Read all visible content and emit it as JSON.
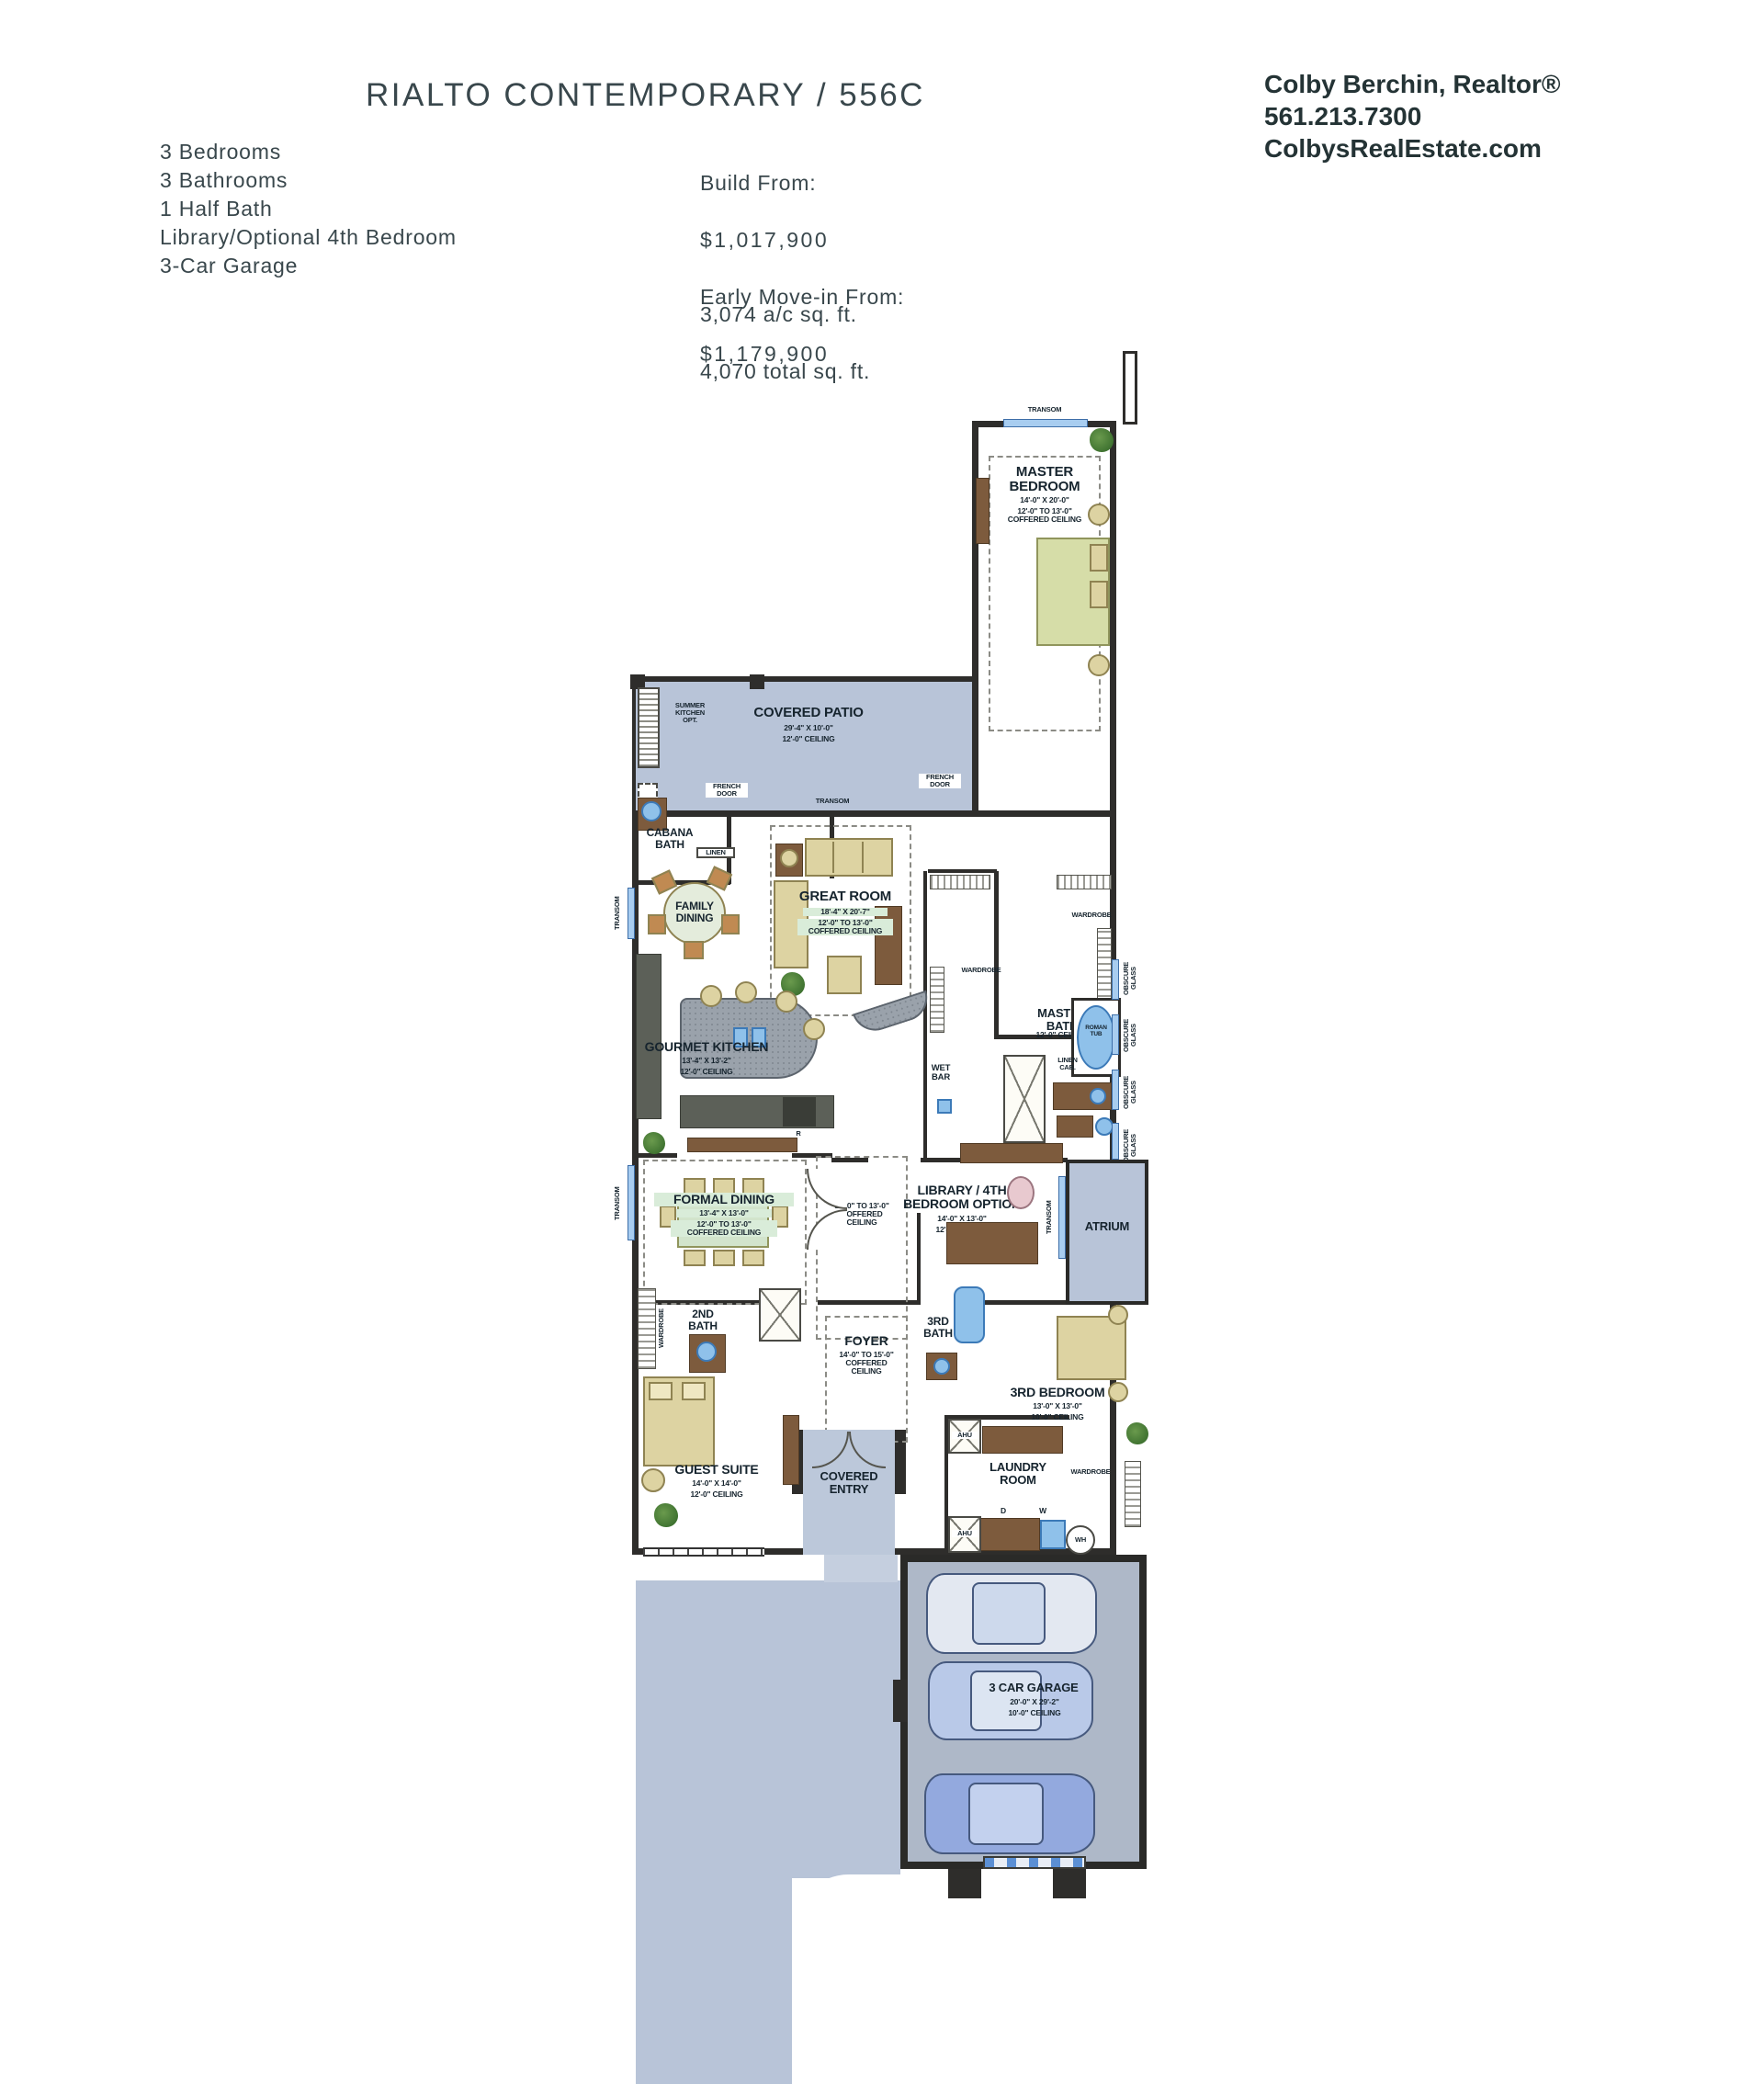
{
  "header": {
    "title": "RIALTO CONTEMPORARY / 556C",
    "realtor": {
      "name": "Colby Berchin, Realtor®",
      "phone": "561.213.7300",
      "website": "ColbysRealEstate.com"
    },
    "specs": "3 Bedrooms\n3 Bathrooms\n1 Half Bath\nLibrary/Optional 4th Bedroom\n3-Car Garage",
    "pricing": {
      "build_label": "Build From:",
      "build_price": "$1,017,900",
      "movein_label": "Early Move-in From:",
      "movein_price": "$1,179,900"
    },
    "area": {
      "ac": "3,074 a/c sq. ft.",
      "total": "4,070 total sq. ft."
    }
  },
  "floorplan": {
    "rooms": {
      "covered_patio": {
        "name": "COVERED PATIO",
        "dims": "29'-4\" X 10'-0\"",
        "ceiling": "12'-0\" CEILING"
      },
      "summer_kitchen": {
        "name": "SUMMER\nKITCHEN\nOPT."
      },
      "master_bedroom": {
        "name": "MASTER\nBEDROOM",
        "dims": "14'-0\" X 20'-0\"",
        "ceiling": "12'-0\" TO 13'-0\"\nCOFFERED CEILING"
      },
      "cabana_bath": {
        "name": "CABANA\nBATH"
      },
      "family_dining": {
        "name": "FAMILY\nDINING"
      },
      "great_room": {
        "name": "GREAT ROOM",
        "dims": "18'-4\" X 20'-7\"",
        "ceiling": "12'-0\" TO 13'-0\"\nCOFFERED CEILING"
      },
      "gourmet_kitchen": {
        "name": "GOURMET KITCHEN",
        "dims": "13'-4\" X 13'-2\"",
        "ceiling": "12'-0\" CEILING"
      },
      "master_bath": {
        "name": "MASTER\nBATH",
        "ceiling": "12'-0\" CEILING"
      },
      "formal_dining": {
        "name": "FORMAL DINING",
        "dims": "13'-4\" X 13'-0\"",
        "ceiling": "12'-0\" TO 13'-0\"\nCOFFERED CEILING"
      },
      "gallery": {
        "ceiling": "12'-0\" TO 13'-0\"\nCOFFERED\nCEILING"
      },
      "library": {
        "name": "LIBRARY / 4TH\nBEDROOM OPTION",
        "dims": "14'-0\" X 13'-0\"",
        "ceiling": "12'-0\" CEILING"
      },
      "atrium": {
        "name": "ATRIUM"
      },
      "second_bath": {
        "name": "2ND\nBATH"
      },
      "foyer": {
        "name": "FOYER",
        "ceiling": "14'-0\" TO 15'-0\"\nCOFFERED\nCEILING"
      },
      "third_bath": {
        "name": "3RD\nBATH"
      },
      "third_bedroom": {
        "name": "3RD BEDROOM",
        "dims": "13'-0\" X 13'-0\"",
        "ceiling": "10'-0\" CEILING"
      },
      "guest_suite": {
        "name": "GUEST SUITE",
        "dims": "14'-0\" X 14'-0\"",
        "ceiling": "12'-0\" CEILING"
      },
      "covered_entry": {
        "name": "COVERED\nENTRY"
      },
      "laundry": {
        "name": "LAUNDRY\nROOM",
        "dryer": "D",
        "washer": "W"
      },
      "garage": {
        "name": "3 CAR GARAGE",
        "dims": "20'-0\" X 29'-2\"",
        "ceiling": "10'-0\" CEILING"
      }
    },
    "labels": {
      "transom": "TRANSOM",
      "french_door": "FRENCH\nDOOR",
      "obscure_glass": "OBSCURE\nGLASS",
      "wardrobe": "WARDROBE",
      "linen": "LINEN",
      "linen_cab": "LINEN\nCAB.",
      "wet_bar": "WET\nBAR",
      "roman_tub": "ROMAN\nTUB",
      "ahu": "AHU",
      "wh": "WH",
      "do": "D.O.",
      "range": "R"
    }
  }
}
